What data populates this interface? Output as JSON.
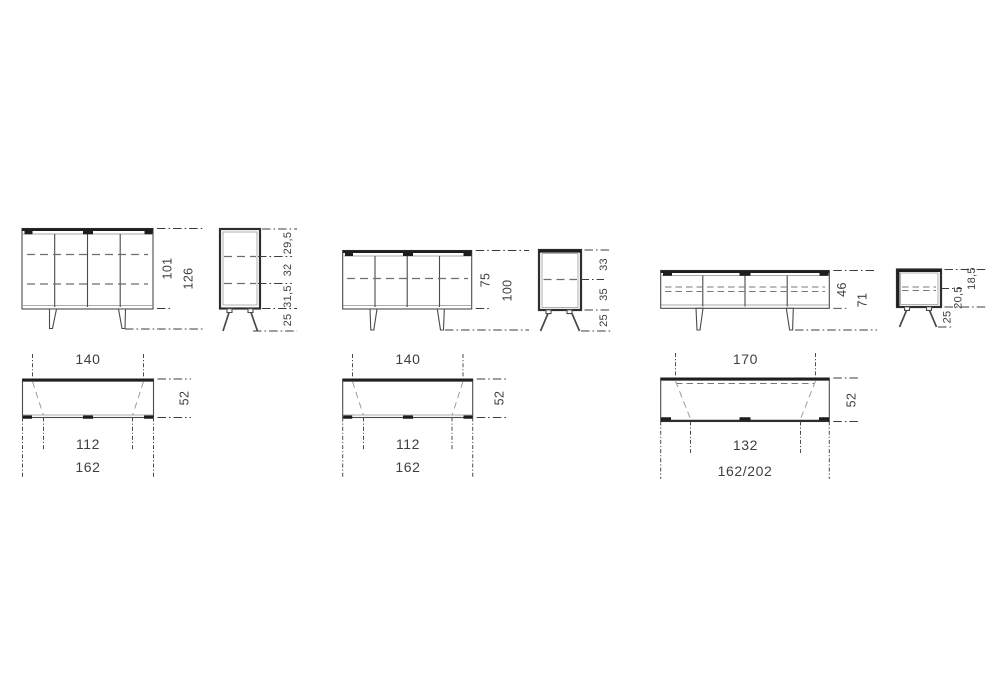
{
  "document_type": "furniture dimension drawing",
  "colors": {
    "background": "#ffffff",
    "line": "#4a4a4a",
    "accent_line": "#1f1f1f",
    "text": "#3e3e44"
  },
  "views": {
    "sideboard_high": {
      "front": {
        "body_height": "101",
        "total_height": "126"
      },
      "side": {
        "section_top": "29,5",
        "section_middle": "32",
        "section_bottom": "31,5",
        "leg_height": "25"
      },
      "plan": {
        "top_width": "140",
        "depth": "52",
        "leg_span": "112",
        "total_width": "162"
      }
    },
    "sideboard_low": {
      "front": {
        "body_height": "75",
        "total_height": "100"
      },
      "side": {
        "section_top": "33",
        "section_bottom": "35",
        "leg_height": "25"
      },
      "plan": {
        "top_width": "140",
        "depth": "52",
        "leg_span": "112",
        "total_width": "162"
      }
    },
    "tv_bench": {
      "front": {
        "body_height": "46",
        "total_height": "71"
      },
      "side": {
        "section_top": "18,5",
        "section_bottom": "20,5",
        "leg_height": "25"
      },
      "plan": {
        "top_width": "170",
        "depth": "52",
        "leg_span": "132",
        "total_width": "162/202"
      }
    }
  }
}
